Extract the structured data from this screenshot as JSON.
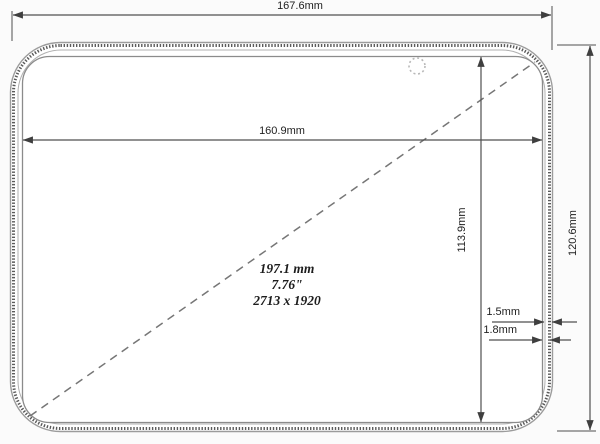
{
  "drawing": {
    "labels": {
      "outer_width": "167.6mm",
      "display_width": "160.9mm",
      "display_height": "113.9mm",
      "outer_height": "120.6mm",
      "bezel_gap_inner": "1.5mm",
      "bezel_gap_outer": "1.8mm",
      "diagonal_mm": "197.1 mm",
      "diagonal_inches": "7.76\"",
      "resolution": "2713 x 1920"
    },
    "colors": {
      "line": "#4f4f4f",
      "background": "#fbfbfb"
    }
  }
}
